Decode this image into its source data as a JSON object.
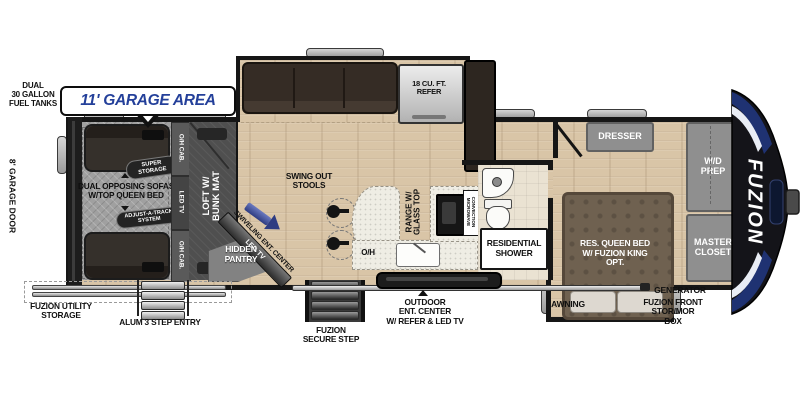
{
  "plan": {
    "garage_callout": "11' GARAGE AREA",
    "fuel_tanks": "DUAL\n30 GALLON\nFUEL TANKS",
    "garage_door": "8' GARAGE DOOR",
    "utility_storage": "FUZION UTILITY\nSTORAGE",
    "step_entry": "ALUM 3 STEP ENTRY",
    "secure_step": "FUZION\nSECURE STEP",
    "outdoor_ent": "OUTDOOR\nENT. CENTER\nW/ REFER & LED TV",
    "awning": "AWNING",
    "generator": "GENERATOR",
    "front_storage": "FUZION FRONT\nSTOR/MOR\nBOX",
    "brand": "FUZION"
  },
  "garage": {
    "sofas": "DUAL OPPOSING SOFAS\nW/TOP QUEEN BED",
    "super_storage": "SUPER\nSTORAGE",
    "adjust_track": "ADJUST-A-TRACK\nSYSTEM",
    "oh_cab_top": "O/H CAB.",
    "led_tv": "LED TV",
    "oh_cab_bottom": "O/H CAB.",
    "loft": "LOFT W/\nBUNK MAT"
  },
  "living": {
    "swivel_center": "SWIVELING ENT. CENTER",
    "swivel_tv": "LED TV",
    "hidden_pantry": "HIDDEN\nPANTRY",
    "stools": "SWING OUT\nSTOOLS",
    "overhead": "O/H",
    "range": "RANGE W/\nGLASS TOP",
    "microwave": "CONVECTION\nMICROWAVE",
    "refer": "18 CU. FT.\nREFER"
  },
  "bath": {
    "shower": "RESIDENTIAL\nSHOWER"
  },
  "bedroom": {
    "dresser": "DRESSER",
    "bed": "RES. QUEEN BED\nW/ FUZION KING\nOPT.",
    "wd_prep": "W/D\nPREP",
    "master_closet": "MASTER\nCLOSET"
  },
  "colors": {
    "accent_blue": "#24409a",
    "wall": "#161616"
  }
}
